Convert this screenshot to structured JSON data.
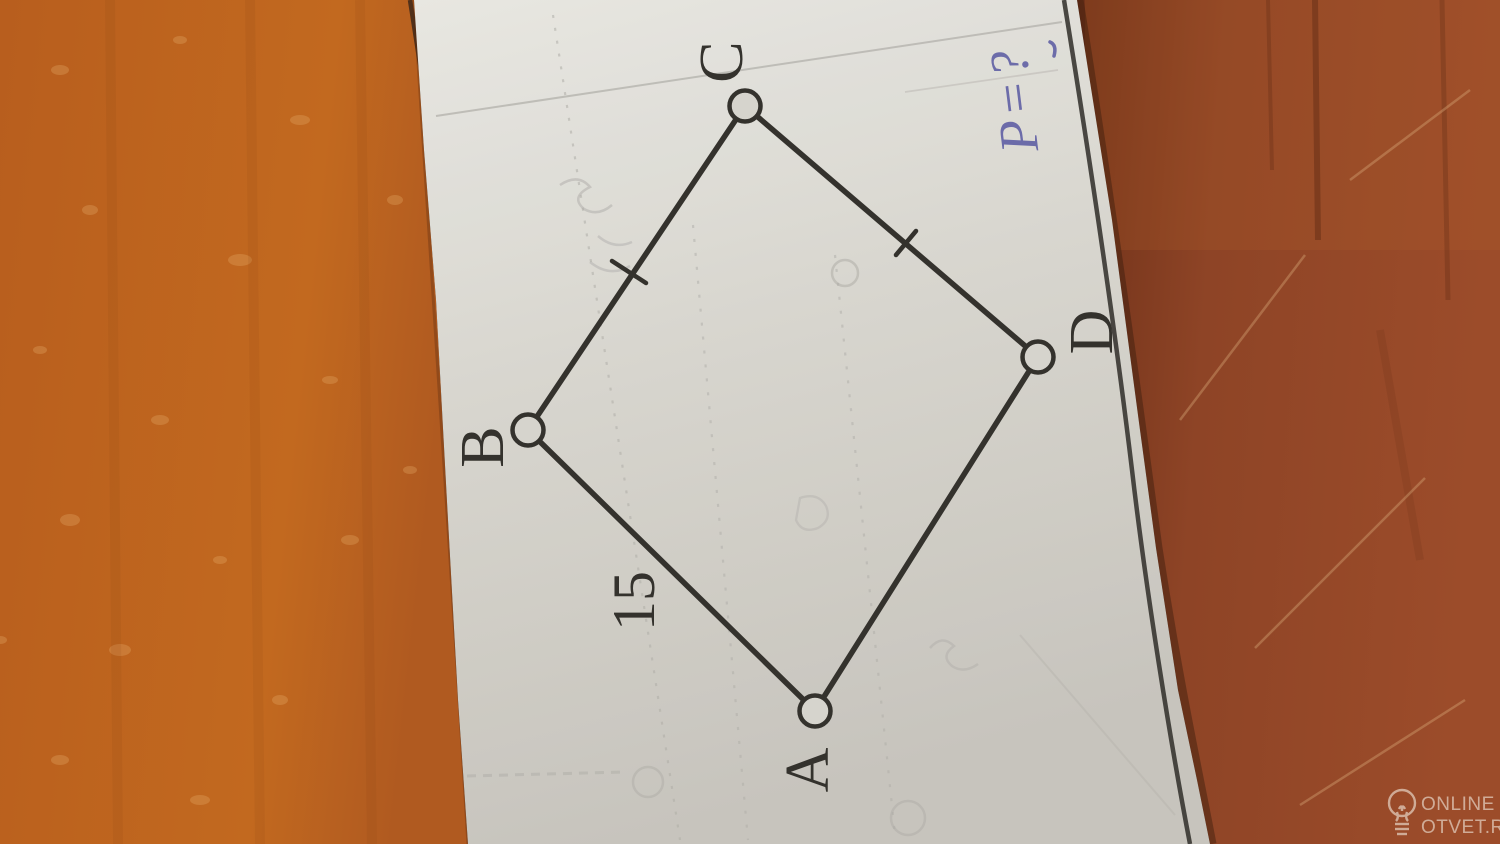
{
  "scene": {
    "type": "photo",
    "subject": "textbook geometry figure on a paper strip lying on a wooden table"
  },
  "figure": {
    "shape": "quadrilateral",
    "vertices": [
      {
        "label": "A"
      },
      {
        "label": "B"
      },
      {
        "label": "C"
      },
      {
        "label": "D"
      }
    ],
    "side_ab_length": "15",
    "tick_marked_sides": "BC and CD",
    "handwritten_question": "P=?"
  },
  "watermark": {
    "icon": "lightbulb-icon",
    "line1": "ONLINE",
    "line2": "OTVET.RU"
  },
  "colors": {
    "ink": "#33312d",
    "pen_blue": "#5d5da8",
    "paper_top": "#edecdf",
    "paper_mid": "#dbd9d3",
    "paper_bottom": "#ceccc5",
    "wood_left": "#bf6522",
    "wood_left_speckle": "#dfa05f",
    "wood_right": "#8e4426",
    "wood_right_dark": "#6f3119",
    "bleed_gray": "#b2b0ac",
    "watermark": "#f0e6da"
  }
}
